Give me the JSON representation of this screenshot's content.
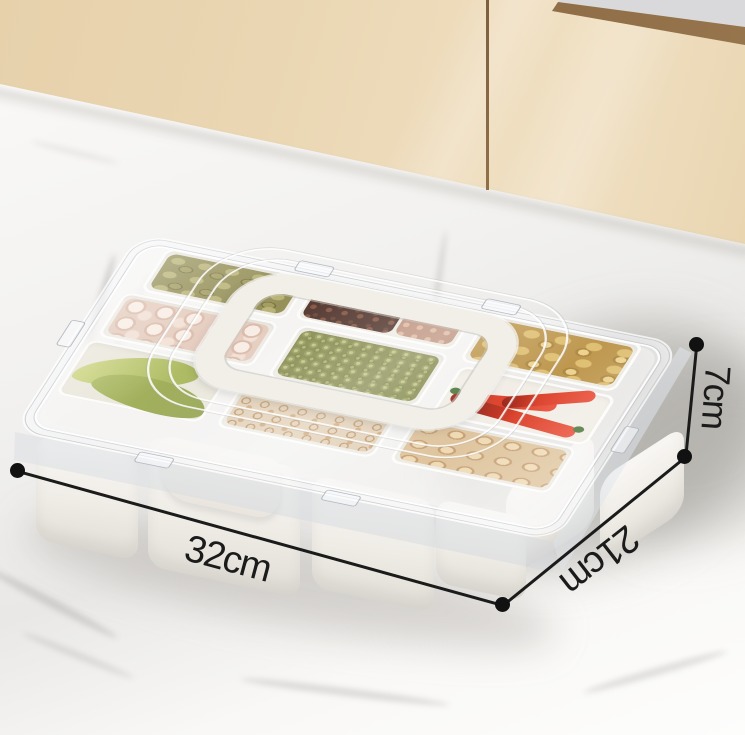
{
  "image": {
    "kind": "product photo",
    "subject": "Divided spice storage box with clear latching lid and built-in carry handle",
    "setting": "white marble kitchen counter in front of beige cabinet doors"
  },
  "dimensions": {
    "length_label": "32cm",
    "depth_label": "21cm",
    "height_label": "7cm"
  },
  "palette": {
    "annotation_line": "#1b1b1b",
    "cabinet": "#e9d4af",
    "cabinet_trim": "#8e6c46",
    "marble": "#f7f6f4",
    "box_white": "#f2efe8",
    "lid_glass": "rgba(240,244,248,0.45)"
  },
  "compartments": [
    {
      "name": "cardamom pods",
      "color": "#a19a5c"
    },
    {
      "name": "garlic cloves",
      "color": "#eed6c8"
    },
    {
      "name": "bay leaves",
      "color": "#a8b457"
    },
    {
      "name": "dark dried spice",
      "color": "#4a2b21"
    },
    {
      "name": "dried shrimp bits",
      "color": "#bd8f79"
    },
    {
      "name": "green peppercorns",
      "color": "#8f9452"
    },
    {
      "name": "dried lily curls",
      "color": "#c9a06b"
    },
    {
      "name": "ginger slices",
      "color": "#c4a155"
    },
    {
      "name": "red chilies",
      "color": "#d42d15"
    },
    {
      "name": "mushroom slices",
      "color": "#d9bc92"
    }
  ]
}
